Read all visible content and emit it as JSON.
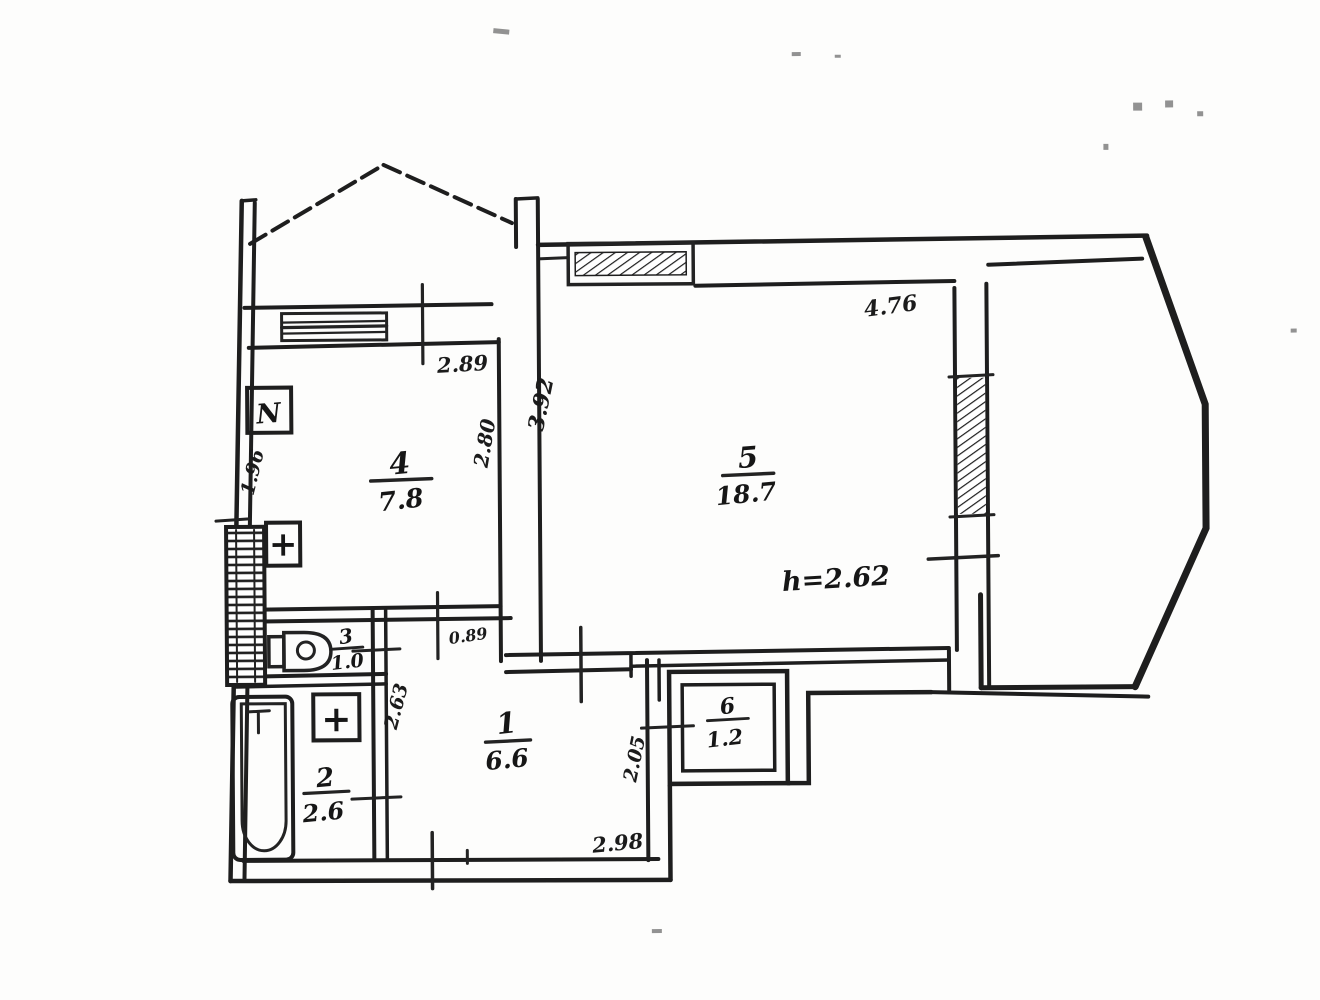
{
  "meta": {
    "kind": "Scanned apartment floor plan",
    "ink_color": "#1e1e1e",
    "paper_color": "#fdfdfc"
  },
  "rooms": [
    {
      "number": "1",
      "area": "6.6"
    },
    {
      "number": "2",
      "area": "2.6"
    },
    {
      "number": "3",
      "area": "1.0"
    },
    {
      "number": "4",
      "area": "7.8"
    },
    {
      "number": "5",
      "area": "18.7"
    },
    {
      "number": "6",
      "area": "1.2"
    }
  ],
  "notes": {
    "ceiling_height": "h=2.62"
  },
  "dimensions": {
    "kitchen_top_width": "2.89",
    "kitchen_right_depth": "2.80",
    "kitchen_left_side": "1.96",
    "living_top_width": "4.76",
    "living_left_depth": "3.92",
    "hall_bottom_width": "2.98",
    "hall_left_side": "2.63",
    "closet_left_side": "2.05",
    "kitchen_door_width": "0.89"
  },
  "fixtures": {
    "stove_label": "N",
    "kitchen_sink_symbol": "+",
    "bath_sink_symbol": "+"
  }
}
